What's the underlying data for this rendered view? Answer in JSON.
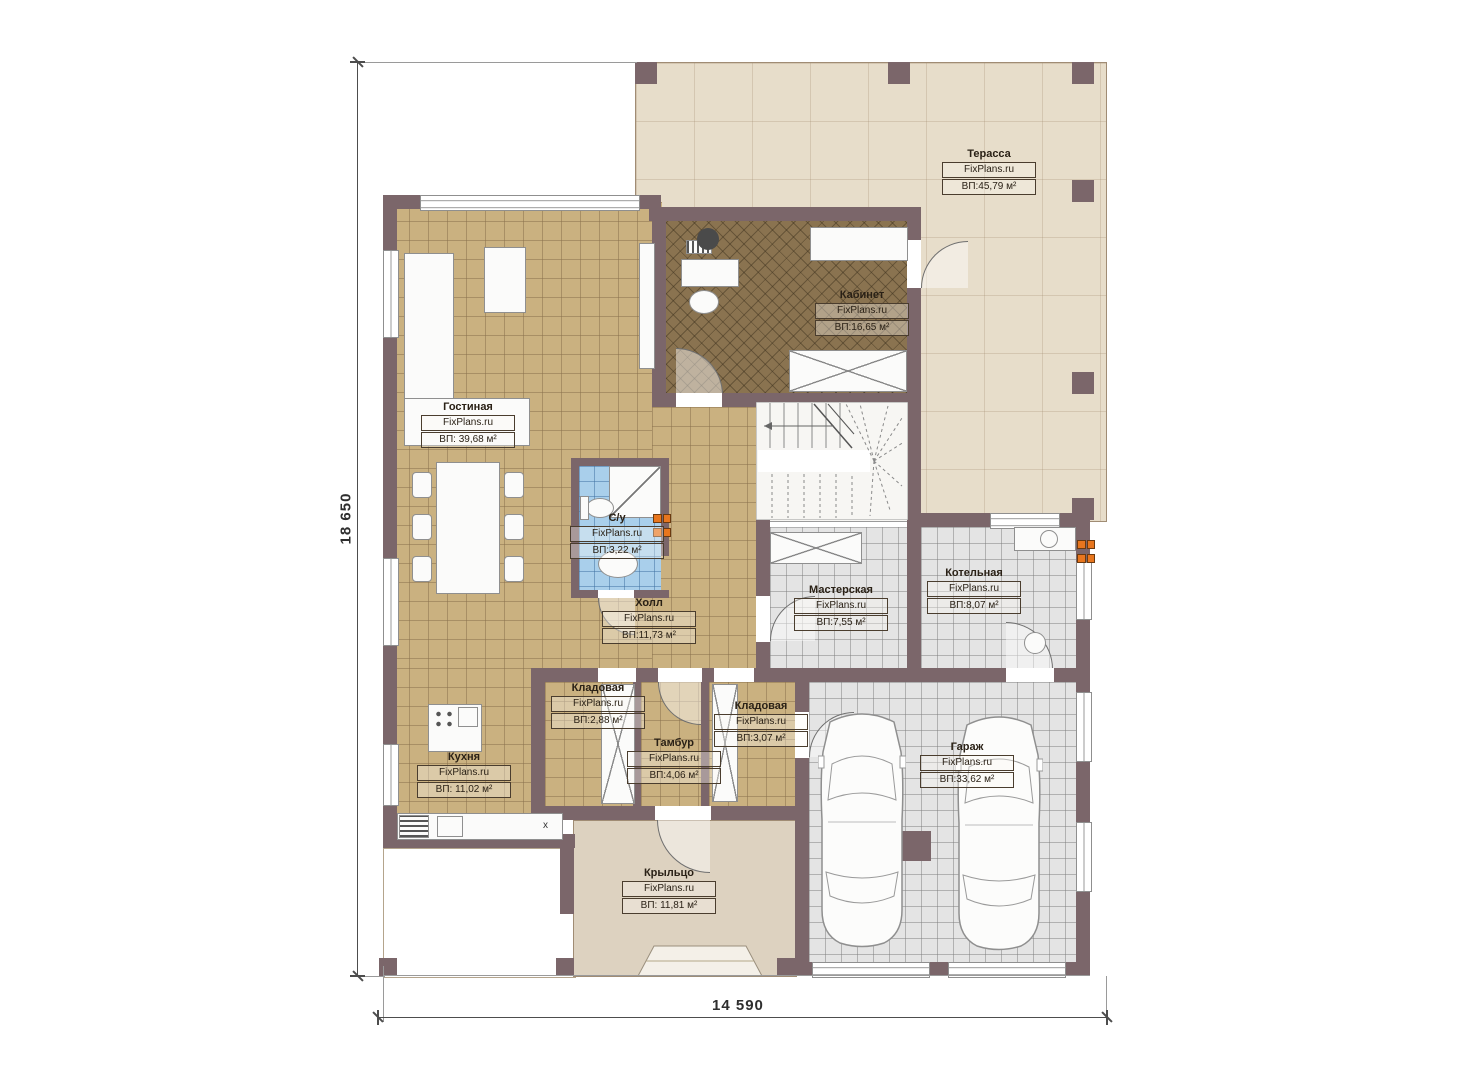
{
  "site_label": "FixPlans.ru",
  "dimensions": {
    "vertical": "18 650",
    "horizontal": "14 590"
  },
  "rooms": [
    {
      "name": "Терасса",
      "area": "ВП:45,79 м²"
    },
    {
      "name": "Кабинет",
      "area": "ВП:16,65 м²"
    },
    {
      "name": "Гостиная",
      "area": "ВП: 39,68 м²"
    },
    {
      "name": "С/у",
      "area": "ВП:3,22 м²"
    },
    {
      "name": "Холл",
      "area": "ВП:11,73 м²"
    },
    {
      "name": "Мастерская",
      "area": "ВП:7,55 м²"
    },
    {
      "name": "Котельная",
      "area": "ВП:8,07 м²"
    },
    {
      "name": "Кладовая",
      "area": "ВП:2,88 м²"
    },
    {
      "name": "Кладовая",
      "area": "ВП:3,07 м²"
    },
    {
      "name": "Тамбур",
      "area": "ВП:4,06 м²"
    },
    {
      "name": "Кухня",
      "area": "ВП: 11,02 м²"
    },
    {
      "name": "Гараж",
      "area": "ВП:33,62 м²"
    },
    {
      "name": "Крыльцо",
      "area": "ВП: 11,81 м²"
    }
  ],
  "kitchen_mark": "x",
  "colors": {
    "wall": "#7b666a",
    "tan_tile": "#cab180",
    "gray_tile": "#e4e4e4",
    "blue_tile": "#a9cfeb",
    "office_carpet": "#8a7350",
    "terrace": "#e7ddca",
    "porch": "#ddd2c0",
    "outlet_orange": "#e8761e"
  }
}
